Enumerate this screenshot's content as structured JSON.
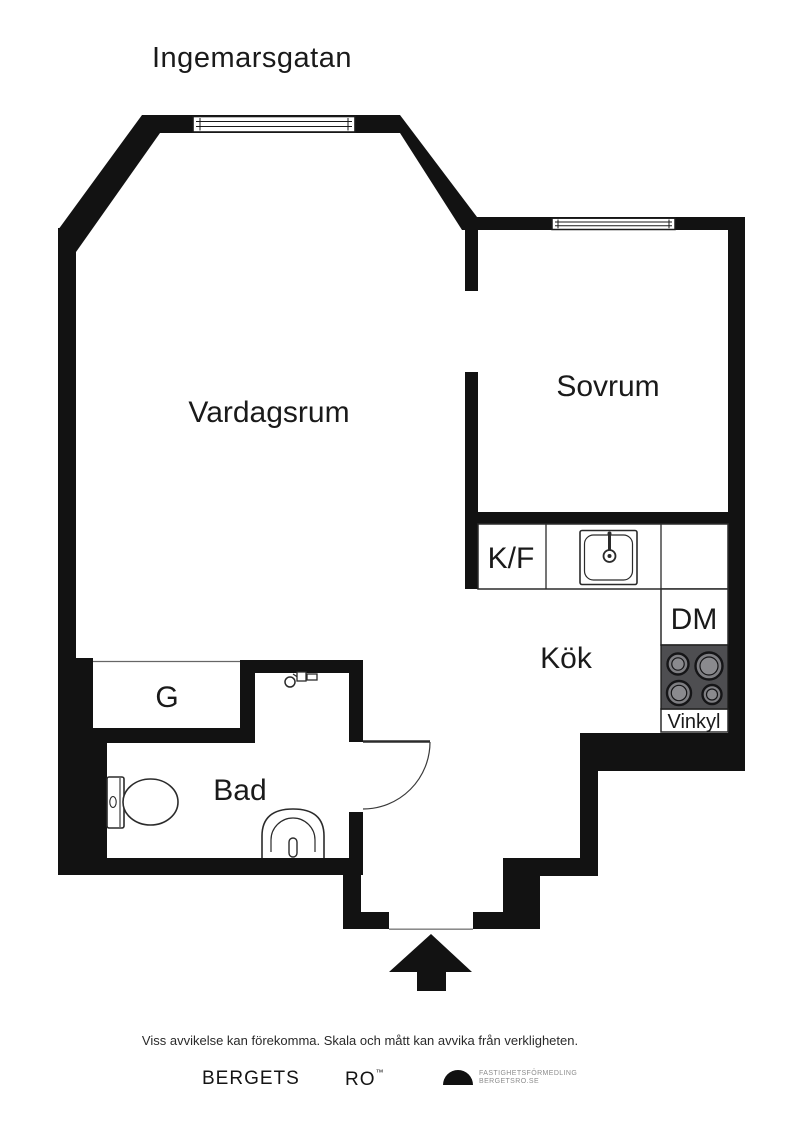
{
  "page": {
    "title": "Ingemarsgatan"
  },
  "floorplan": {
    "rooms": {
      "vardagsrum": "Vardagsrum",
      "sovrum": "Sovrum",
      "kok": "Kök",
      "kf": "K/F",
      "dm": "DM",
      "vinkyl": "Vinkyl",
      "garderob": "G",
      "bad": "Bad"
    },
    "colors": {
      "wall": "#121212",
      "stove_body": "#4e4e51",
      "burner": "#7e7e82",
      "fixture_line": "#2b2b2b"
    }
  },
  "disclaimer": "Viss avvikelse kan förekomma. Skala och mått kan avvika från verkligheten.",
  "footer": {
    "brand_word1": "BERGETS",
    "brand_word2": "RO",
    "brand_tm": "™",
    "agency_line1": "FASTIGHETSFÖRMEDLING",
    "agency_line2": "BERGETSRO.SE"
  }
}
